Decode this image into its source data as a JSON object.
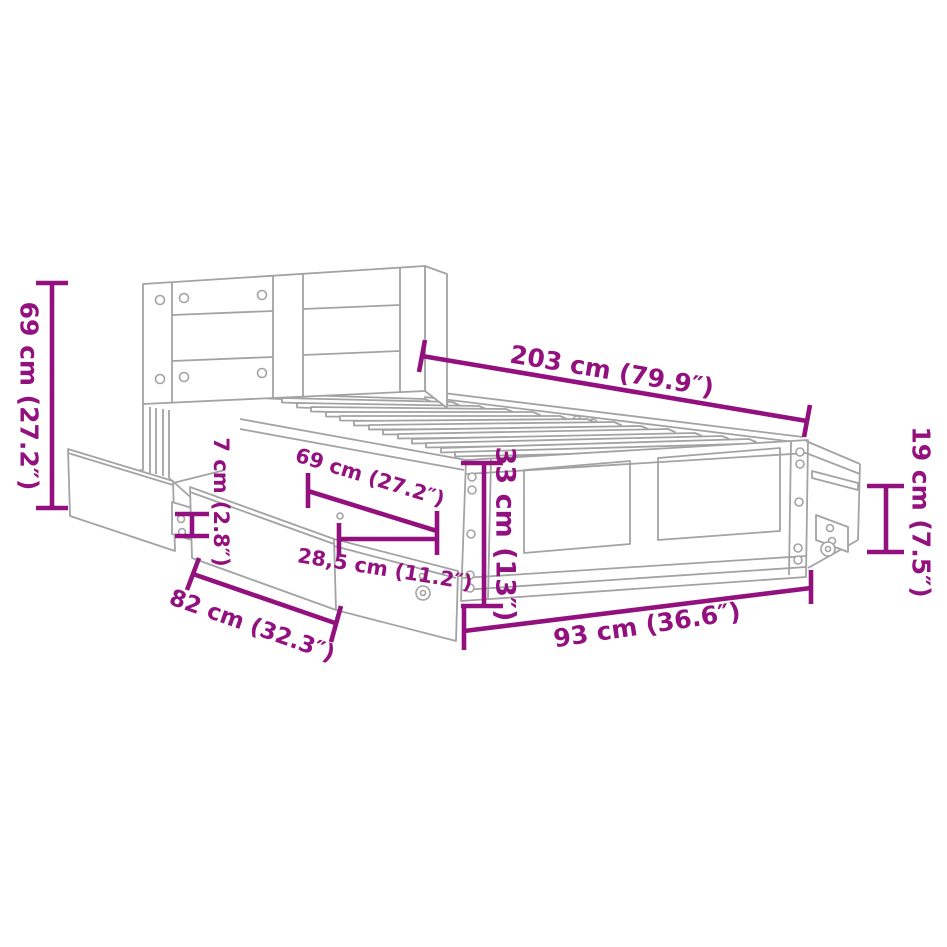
{
  "diagram": {
    "kind": "furniture-dimension-diagram",
    "subject": "bed frame with headboard and pull-out drawers",
    "accent_color": "#93117E",
    "line_color": "#A3A3A3",
    "background": "#FFFFFF",
    "dimensions": {
      "headboard_height": "69 cm (27.2″)",
      "frame_length": "203 cm (79.9″)",
      "headboard_gap": "7 cm (2.8″)",
      "drawer_depth": "69 cm (27.2″)",
      "drawer_pullout": "28,5 cm (11.2″)",
      "frame_height": "33 cm (13″)",
      "caster_height": "19 cm (7.5″)",
      "drawer_width": "82 cm (32.3″)",
      "frame_width": "93 cm (36.6″)"
    }
  }
}
